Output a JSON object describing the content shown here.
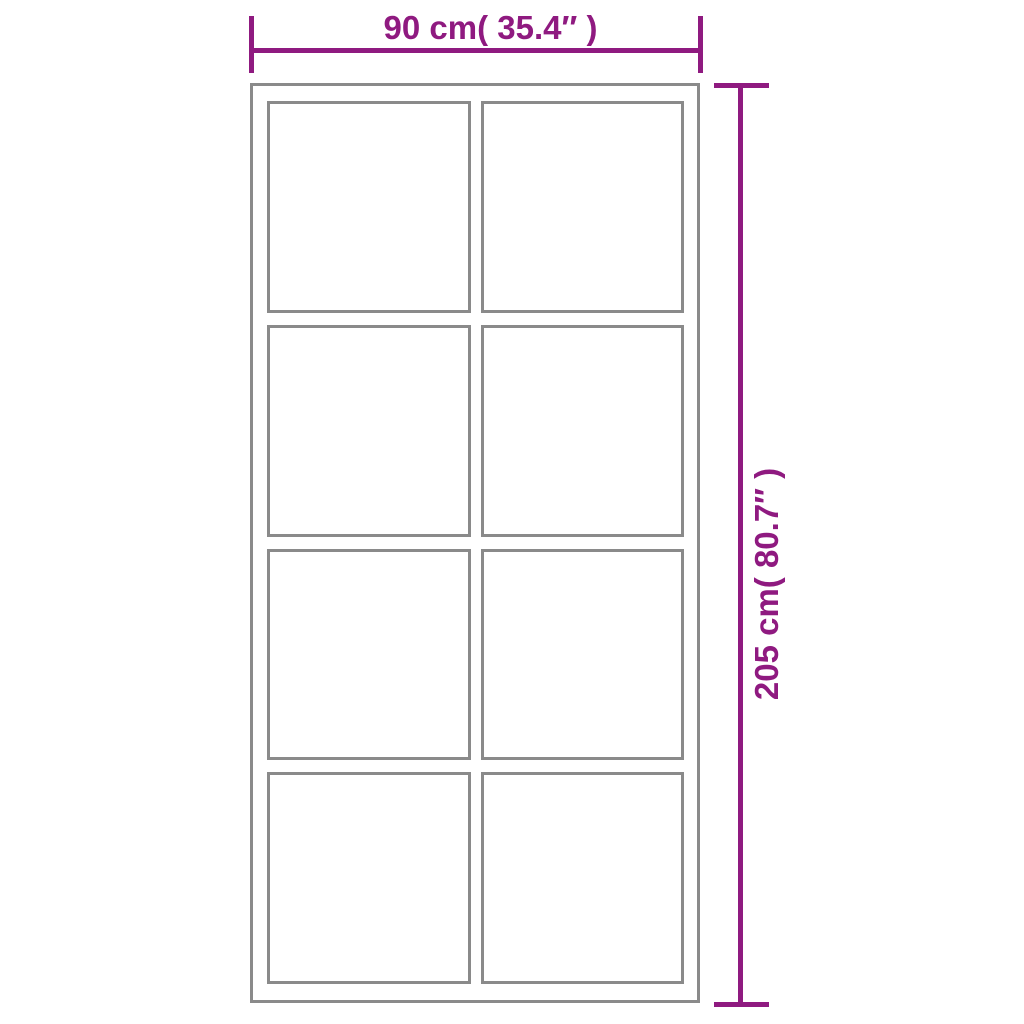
{
  "diagram": {
    "subject": "door-with-glass-panels-dimension-diagram",
    "width_dimension": {
      "label": "90 cm( 35.4″  )"
    },
    "height_dimension": {
      "label": "205 cm( 80.7″  )"
    },
    "door": {
      "panel_rows": 4,
      "panel_columns": 2
    },
    "colors": {
      "dimension_accent": "#8F1A80",
      "frame_gray": "#8A8A8A",
      "background": "#FFFFFF"
    }
  }
}
